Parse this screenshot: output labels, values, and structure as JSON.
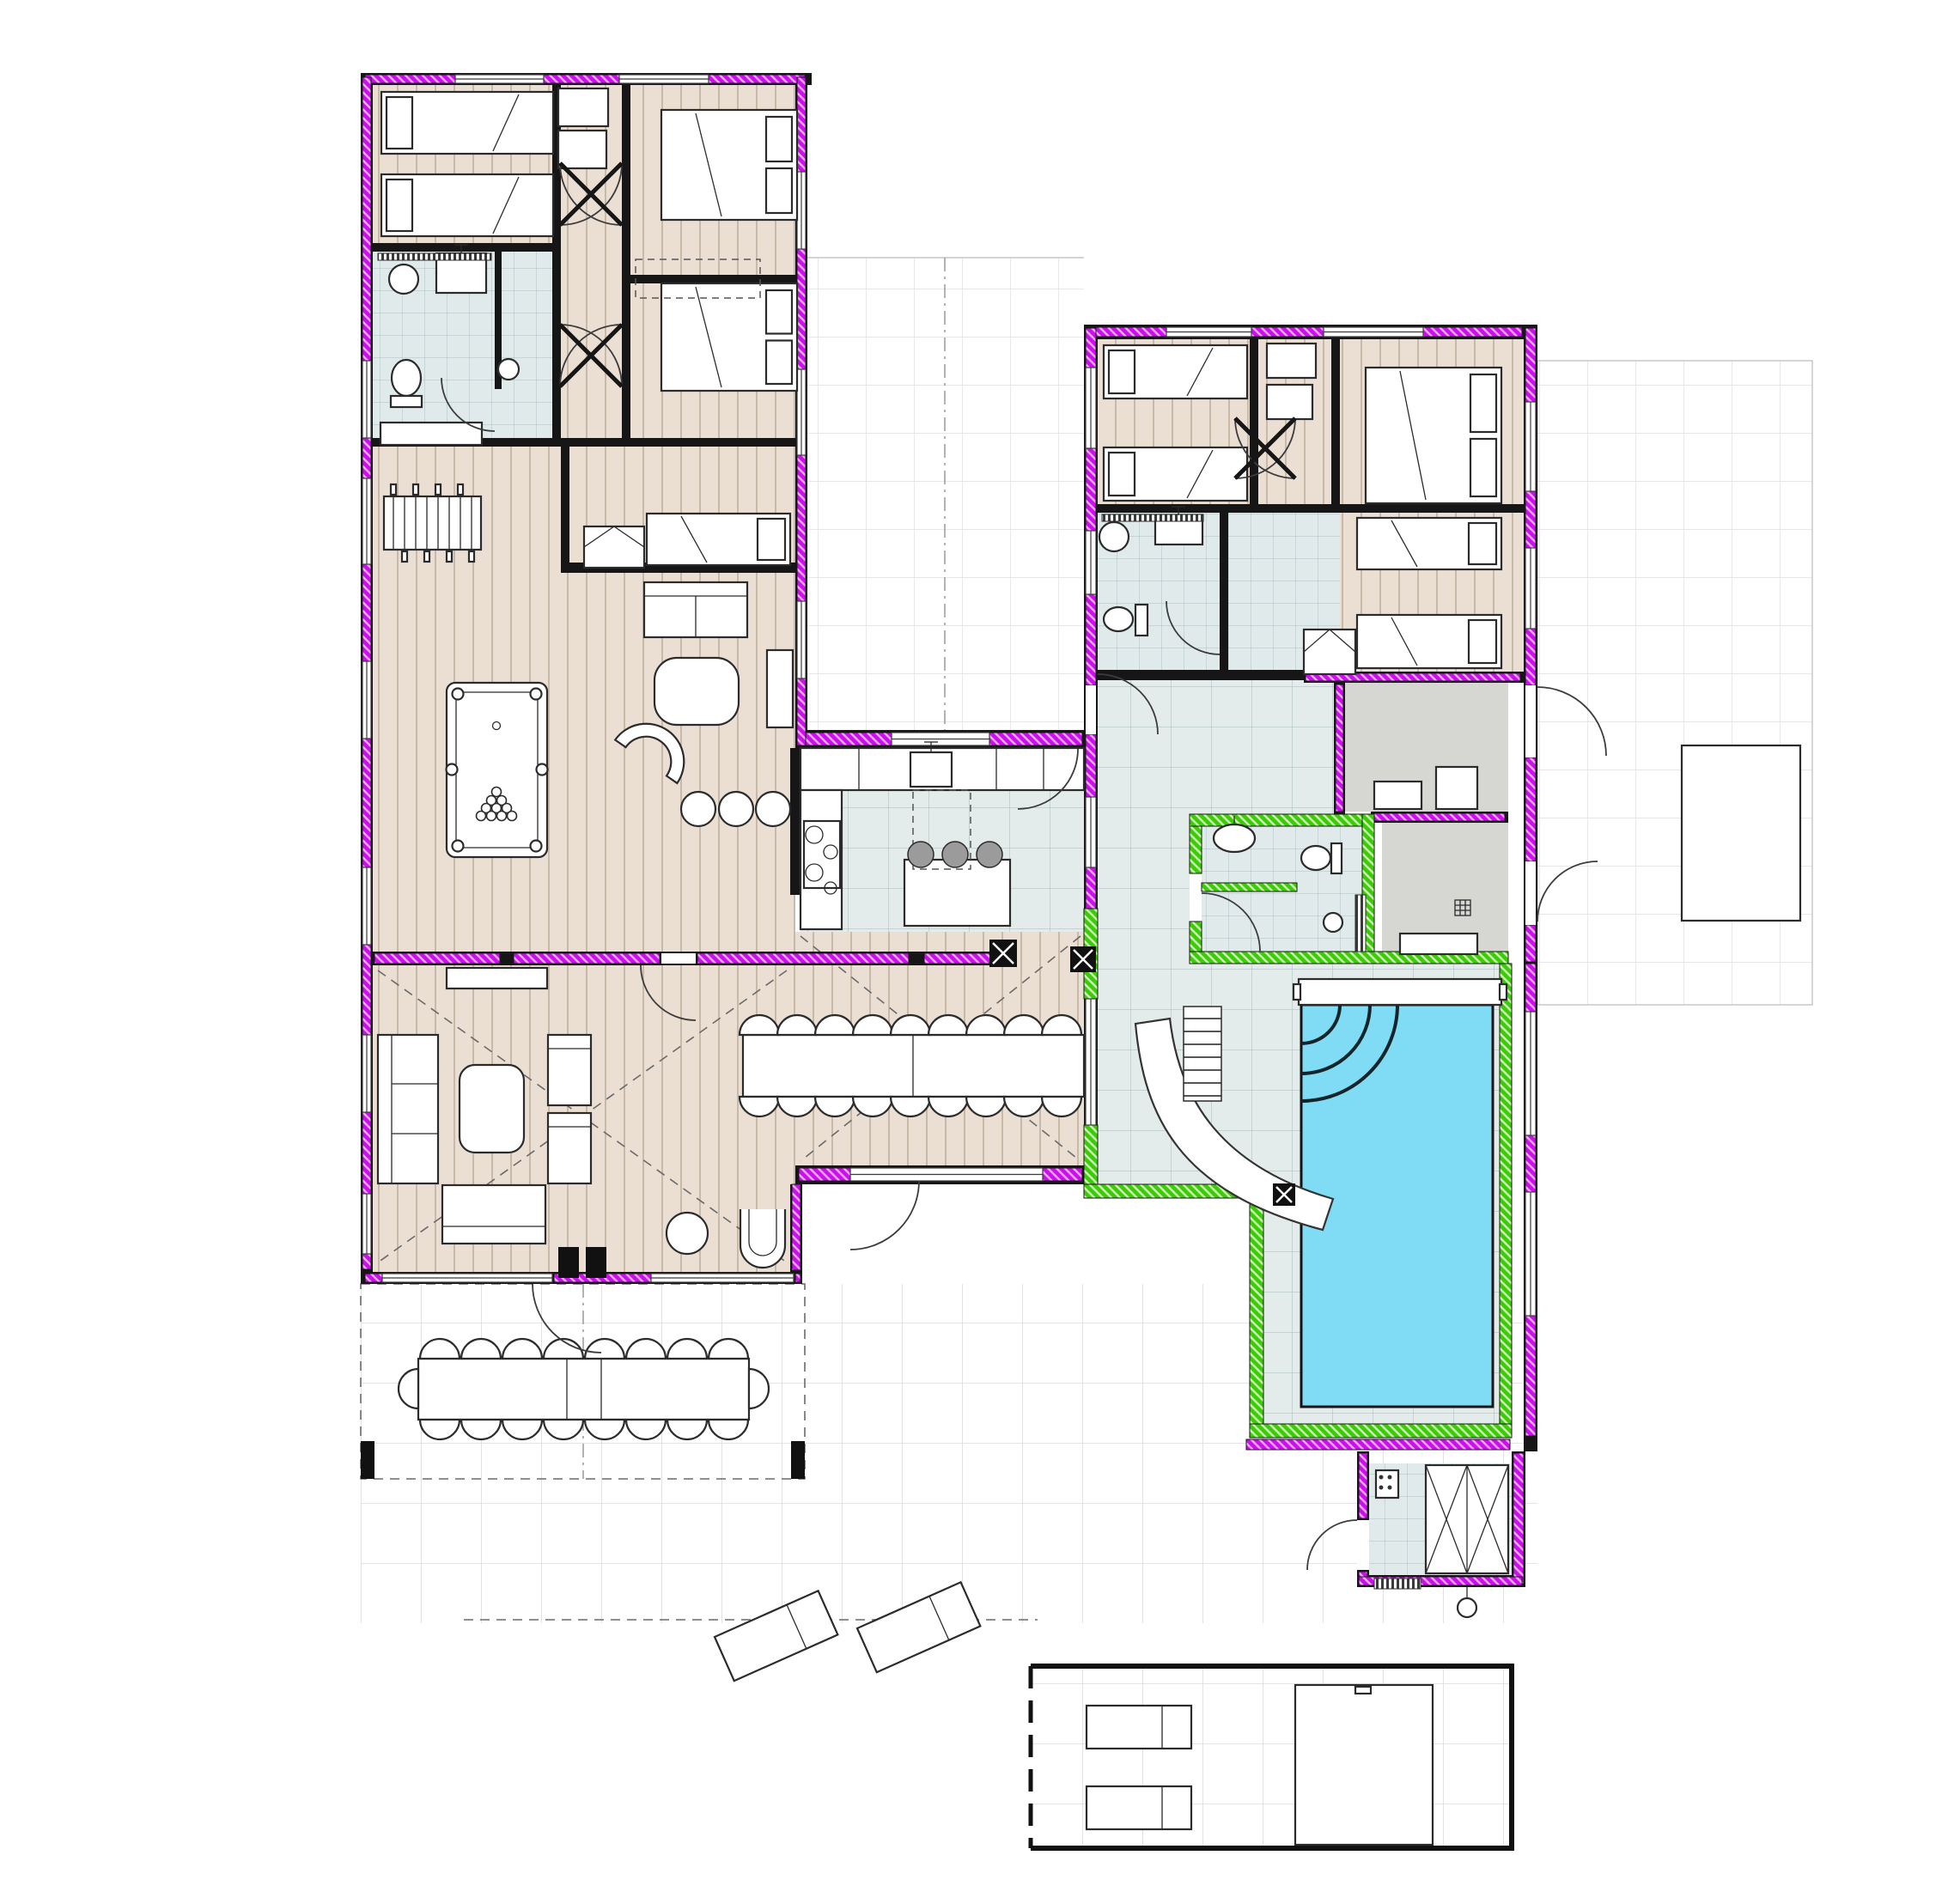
{
  "document": {
    "title": "Holiday villa ground-floor architectural plan",
    "type": "architectural floor plan drawing",
    "visible_text": "none (drawing contains no readable labels)"
  },
  "legend": {
    "exterior_wall_highlight": "#cb10ec",
    "pool_area_wall_highlight": "#3ecb07",
    "pool_water_color": "#80dcf4",
    "hot_tub_water_color": "#8ee3f7",
    "wood_floor_color": "#eadfd2",
    "tile_floor_color": "#e4eceb",
    "bathroom_tile_color": "#e1eaea",
    "utility_floor_color": "#d6d6d3",
    "terrace_floor_color": "#ffffff",
    "wall_color": "#161616"
  },
  "wings": {
    "west_wing_rooms": [
      "twin bedroom",
      "double bedroom",
      "double bedroom",
      "single bedroom",
      "bathroom with shower room",
      "games room with foosball and billiard tables",
      "tv lounge",
      "living room",
      "dining area",
      "kitchen"
    ],
    "east_wing_rooms": [
      "twin bedroom",
      "double bedroom",
      "two-bed room",
      "bathroom",
      "hallway",
      "utility room 1",
      "utility room 2",
      "pool bathroom",
      "indoor pool hall",
      "sauna"
    ],
    "outdoor_areas": [
      "inner courtyard terrace",
      "east terrace",
      "south terrace with pergola",
      "framed southeast terrace"
    ]
  },
  "furniture_inventory": {
    "single_beds": 7,
    "double_beds": 3,
    "toilets": 3,
    "wash_basins": 4,
    "indoor_dining_chairs": 18,
    "outdoor_dining_chairs": 18,
    "kitchen_bar_stools": 3,
    "lounge_stools": 3,
    "sofas": 4,
    "sun_loungers": 4,
    "billiard_table": 1,
    "foosball_table": 1,
    "sauna_benches": 2
  },
  "pools": [
    {
      "name": "indoor swimming pool",
      "features": [
        "corner steps",
        "water slide",
        "stair ladder",
        "safety ledge"
      ]
    },
    {
      "name": "outdoor hot tub",
      "features": [
        "square basin"
      ]
    }
  ]
}
